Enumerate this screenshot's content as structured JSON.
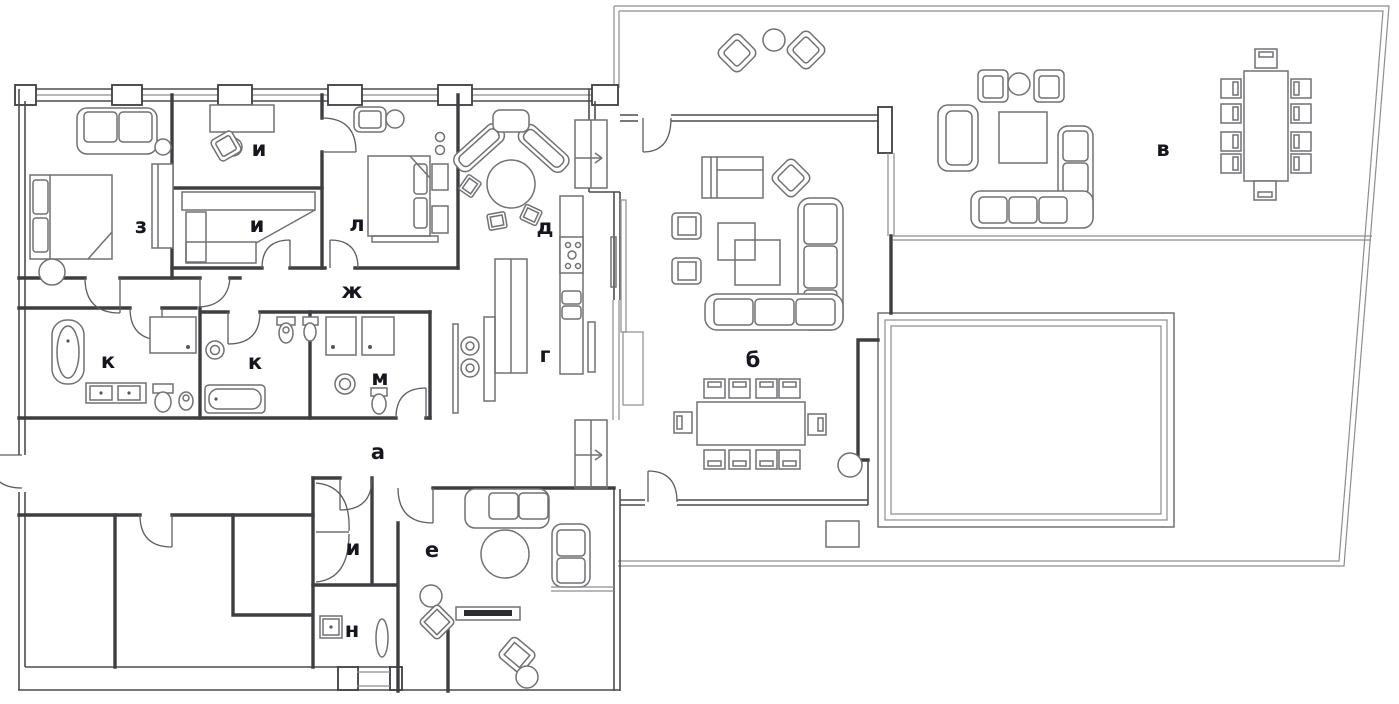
{
  "document": {
    "type": "architectural floor plan",
    "language": "ru"
  },
  "colors": {
    "background": "#ffffff",
    "walls": "#3c3e41",
    "furniture_lines": "#6f7174",
    "terrace_lines": "#8b8d90",
    "labels": "#16171e"
  },
  "rooms": [
    {
      "id": "a",
      "label": "а"
    },
    {
      "id": "b",
      "label": "б"
    },
    {
      "id": "v",
      "label": "в"
    },
    {
      "id": "g",
      "label": "г"
    },
    {
      "id": "d",
      "label": "д"
    },
    {
      "id": "e",
      "label": "е"
    },
    {
      "id": "zh",
      "label": "ж"
    },
    {
      "id": "z",
      "label": "з"
    },
    {
      "id": "i-study",
      "label": "и"
    },
    {
      "id": "i-middle",
      "label": "и"
    },
    {
      "id": "i-closet",
      "label": "и"
    },
    {
      "id": "k-left",
      "label": "к"
    },
    {
      "id": "k-right",
      "label": "к"
    },
    {
      "id": "l",
      "label": "л"
    },
    {
      "id": "m",
      "label": "м"
    },
    {
      "id": "n",
      "label": "н"
    }
  ]
}
